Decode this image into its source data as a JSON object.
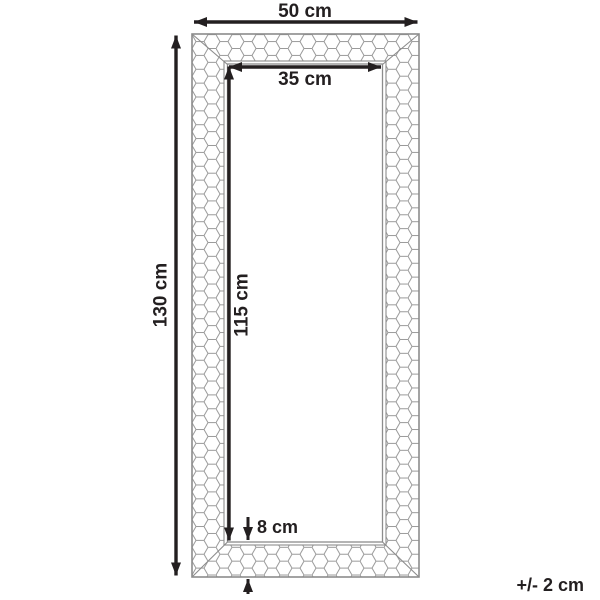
{
  "diagram": {
    "labels": {
      "outer_width": "50 cm",
      "inner_width": "35 cm",
      "outer_height": "130 cm",
      "inner_height": "115 cm",
      "frame_depth": "8 cm",
      "tolerance": "+/- 2 cm"
    },
    "measurements_cm": {
      "outer_width": 50,
      "inner_width": 35,
      "outer_height": 130,
      "inner_height": 115,
      "frame_depth": 8,
      "tolerance": 2
    },
    "colors": {
      "dimension_ink": "#231f20",
      "frame_outline": "#8c8c8c",
      "pattern_line": "#999999",
      "background": "#ffffff"
    }
  }
}
